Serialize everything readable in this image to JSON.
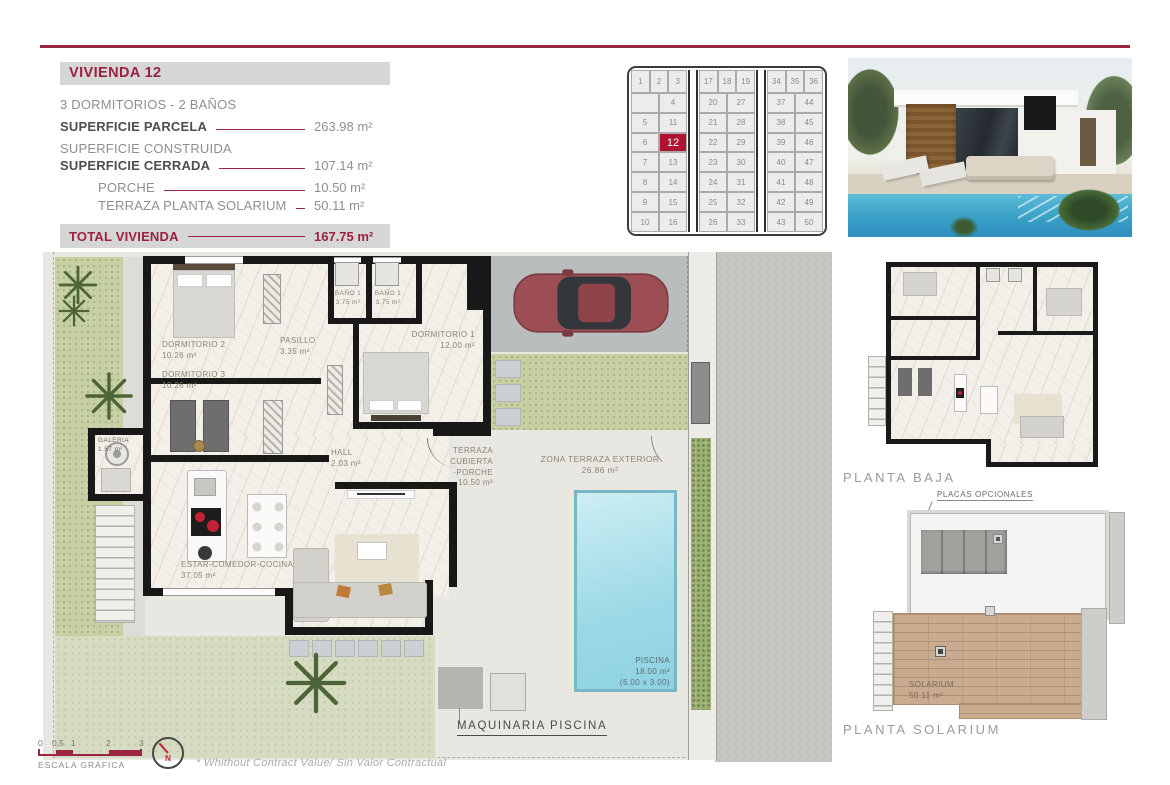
{
  "colors": {
    "accent_maroon": "#9b2140",
    "plot_highlight": "#b01232",
    "header_bar_gray": "#d6d6d6",
    "pool_blue": "#9cd9e6"
  },
  "info_panel": {
    "title": "VIVIENDA 12",
    "subtitle": "3 DORMITORIOS - 2 BAÑOS",
    "superficie_parcela": {
      "label": "SUPERFICIE PARCELA",
      "value": "263.98 m²"
    },
    "superficie_construida": {
      "label": "SUPERFICIE CONSTRUIDA"
    },
    "superficie_cerrada": {
      "label": "SUPERFICIE CERRADA",
      "value": "107.14 m²"
    },
    "porche": {
      "label": "PORCHE",
      "value": "10.50 m²"
    },
    "terraza_planta_solarium": {
      "label": "TERRAZA PLANTA SOLARIUM",
      "value": "50.11 m²"
    },
    "total_vivienda": {
      "label": "TOTAL VIVIENDA",
      "value": "167.75 m²"
    },
    "zona_terraza_exterior": {
      "label": "ZONA TERRAZA EXTERIOR",
      "value": "26.86 m²"
    }
  },
  "site_grid": {
    "highlight": "12",
    "highlight_color": "#b01232",
    "blocks": [
      {
        "top": [
          "1",
          "2",
          "3"
        ],
        "rows": [
          [
            "",
            "4"
          ],
          [
            "5",
            "11"
          ],
          [
            "6",
            "12"
          ],
          [
            "7",
            "13"
          ],
          [
            "8",
            "14"
          ],
          [
            "9",
            "15"
          ],
          [
            "10",
            "16"
          ]
        ]
      },
      {
        "top": [
          "17",
          "18",
          "19"
        ],
        "rows": [
          [
            "20",
            "27"
          ],
          [
            "21",
            "28"
          ],
          [
            "22",
            "29"
          ],
          [
            "23",
            "30"
          ],
          [
            "24",
            "31"
          ],
          [
            "25",
            "32"
          ],
          [
            "26",
            "33"
          ]
        ]
      },
      {
        "top": [
          "34",
          "35",
          "36"
        ],
        "rows": [
          [
            "37",
            "44"
          ],
          [
            "38",
            "45"
          ],
          [
            "39",
            "46"
          ],
          [
            "40",
            "47"
          ],
          [
            "41",
            "48"
          ],
          [
            "42",
            "49"
          ],
          [
            "43",
            "50"
          ]
        ]
      }
    ]
  },
  "plan": {
    "rooms": {
      "dormitorio2": {
        "name": "DORMITORIO 2",
        "area": "10.26 m²"
      },
      "dormitorio3": {
        "name": "DORMITORIO 3",
        "area": "10.26 m²"
      },
      "pasillo": {
        "name": "PASILLO",
        "area": "3.35 m²"
      },
      "bano_a": {
        "name": "BAÑO 1",
        "area": "3.75 m²"
      },
      "bano_b": {
        "name": "BAÑO 1",
        "area": "3.75 m²"
      },
      "dormitorio1": {
        "name": "DORMITORIO 1",
        "area": "12.00 m²"
      },
      "galeria": {
        "name": "GALERIA",
        "area": "1.57 m²"
      },
      "hall": {
        "name": "HALL",
        "area": "2.03 m²"
      },
      "porche": {
        "name": "TERRAZA CUBIERTA",
        "name2": "-PORCHE",
        "area": "10.50 m²"
      },
      "zona_terraza": {
        "name": "ZONA TERRAZA EXTERIOR",
        "area": "26.86 m²"
      },
      "estar": {
        "name": "ESTAR-COMEDOR-COCINA",
        "area": "37.05 m²"
      },
      "piscina": {
        "name": "PISCINA",
        "area": "18.00 m²",
        "dims": "(6.00 x 3.00)"
      }
    },
    "maquinaria_label": "MAQUINARIA PISCINA"
  },
  "planta_baja": {
    "caption": "PLANTA BAJA"
  },
  "planta_solarium": {
    "caption": "PLANTA SOLARIUM",
    "placas_label": "PLACAS OPCIONALES",
    "room": {
      "name": "SOLARIUM",
      "area": "50.11 m²"
    }
  },
  "footer": {
    "scale_ticks": [
      "0",
      "0,5",
      "1",
      "2",
      "3"
    ],
    "scale_label": "ESCALA GRÁFICA",
    "north_label": "N",
    "disclaimer": "* Whithout Contract Value/ Sin Valor Contractual"
  }
}
